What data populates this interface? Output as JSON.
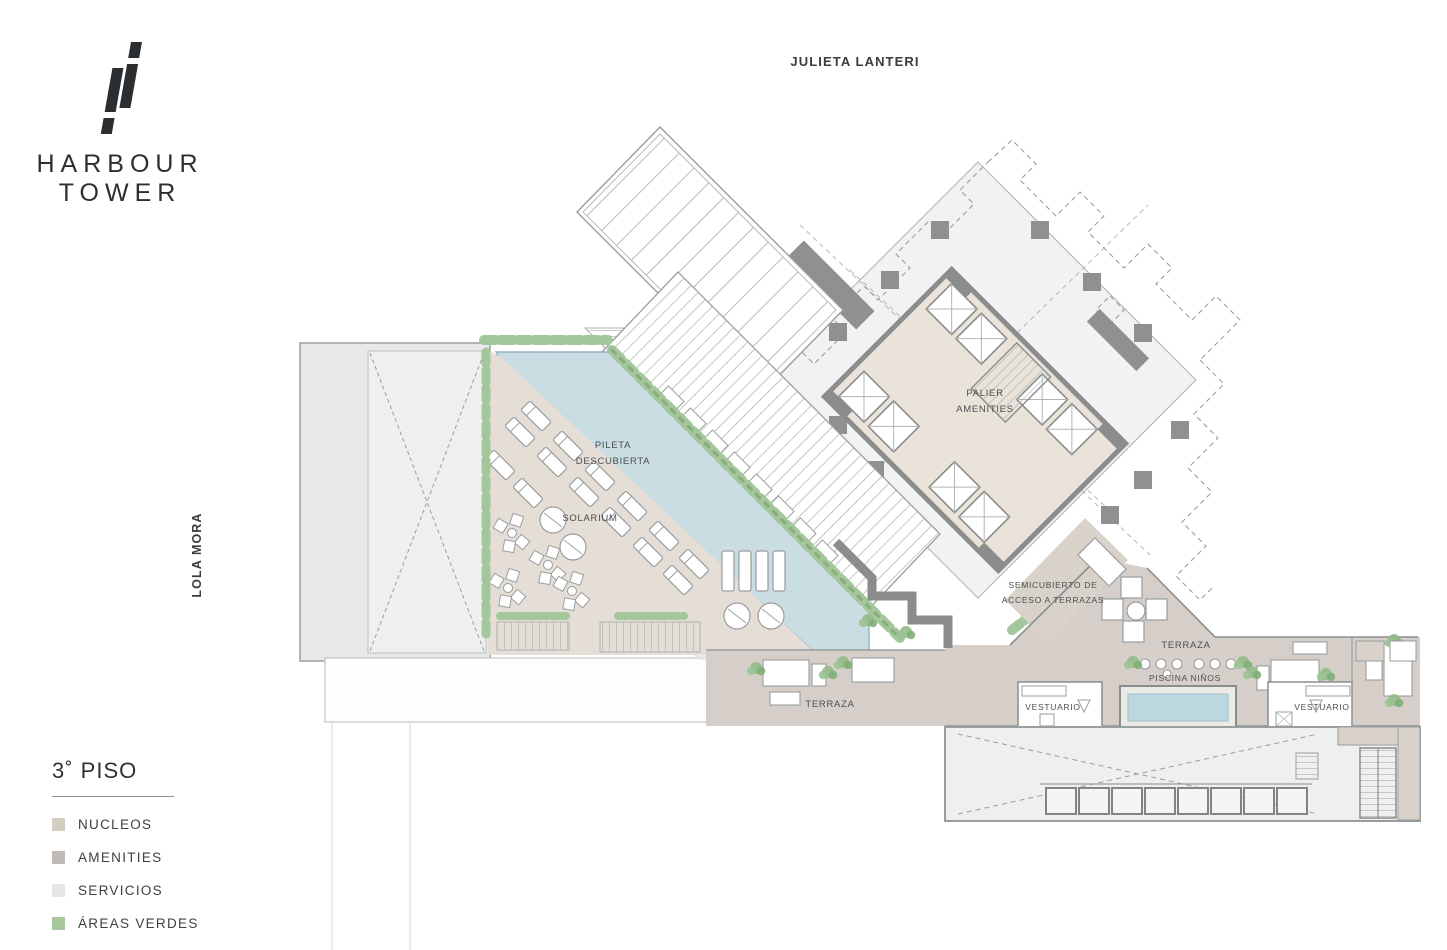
{
  "branding": {
    "line1": "HARBOUR",
    "line2": "TOWER"
  },
  "streets": {
    "top": "JULIETA LANTERI",
    "left": "LOLA MORA"
  },
  "legend": {
    "floor_title": "3˚ PISO",
    "items": [
      {
        "label": "NUCLEOS",
        "color": "#d4cec0"
      },
      {
        "label": "AMENITIES",
        "color": "#c1bab6"
      },
      {
        "label": "SERVICIOS",
        "color": "#e4e7e6"
      },
      {
        "label": "ÁREAS VERDES",
        "color": "#a9c79f"
      }
    ]
  },
  "plan_labels": {
    "pool_line1": "PILETA",
    "pool_line2": "DESCUBIERTA",
    "solarium": "SOLARIUM",
    "palier_line1": "PALIER",
    "palier_line2": "AMENITIES",
    "semicubierto_line1": "SEMICUBIERTO DE",
    "semicubierto_line2": "ACCESO A TERRAZAS",
    "terraza_right": "TERRAZA",
    "terraza_bottom": "TERRAZA",
    "piscina_ninos": "PISCINA NIÑOS",
    "vestuario_left": "VESTUARIO",
    "vestuario_right": "VESTUARIO"
  },
  "plan_colors": {
    "pool_water": "#c9dde3",
    "terrace_tan": "#d6cfc9",
    "solarium_deck": "#e4ded7",
    "core_fill": "#e9e3da",
    "service_gray": "#eef0ef",
    "wall_gray": "#8b8d8d",
    "green": "#a3c79b"
  }
}
